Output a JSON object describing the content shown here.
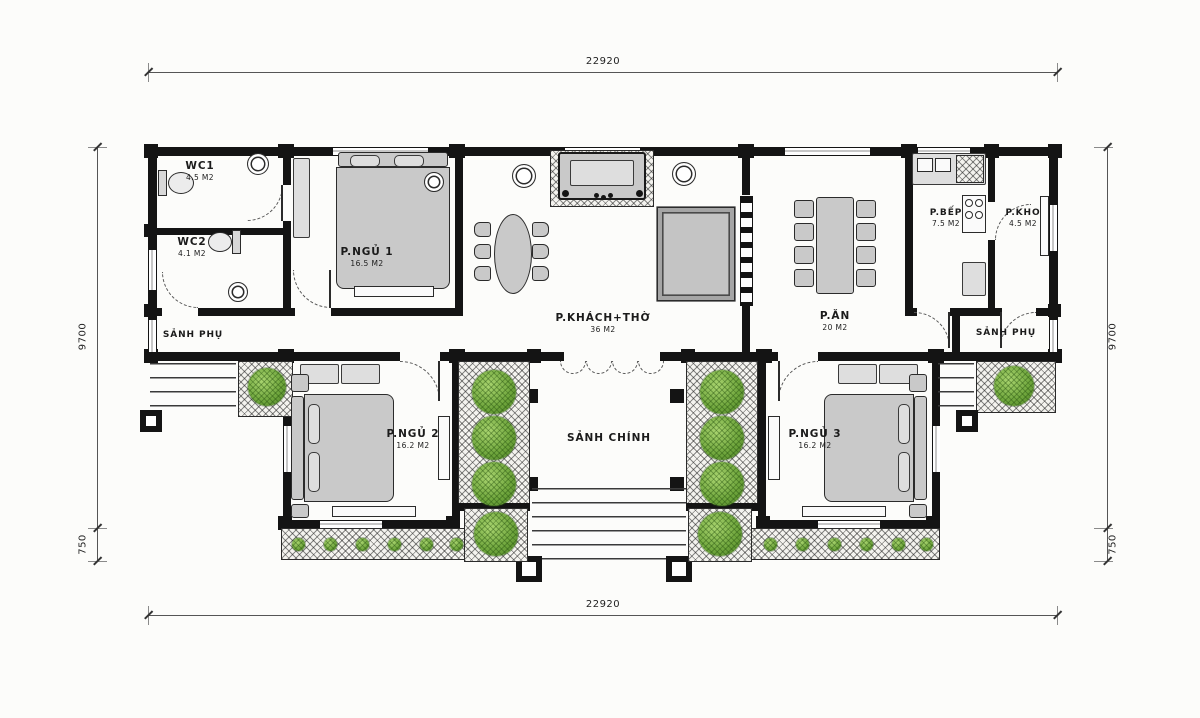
{
  "plan": {
    "rooms": [
      {
        "id": "wc1",
        "name": "WC1",
        "area": "4.5 M2"
      },
      {
        "id": "wc2",
        "name": "WC2",
        "area": "4.1 M2"
      },
      {
        "id": "bedroom1",
        "name": "P.NGỦ 1",
        "area": "16.5 M2"
      },
      {
        "id": "living-worship",
        "name": "P.KHÁCH+THỜ",
        "area": "36 M2"
      },
      {
        "id": "dining",
        "name": "P.ĂN",
        "area": "20 M2"
      },
      {
        "id": "kitchen",
        "name": "P.BẾP",
        "area": "7.5 M2"
      },
      {
        "id": "storage",
        "name": "P.KHO",
        "area": "4.5 M2"
      },
      {
        "id": "side-hall-left",
        "name": "SẢNH PHỤ",
        "area": ""
      },
      {
        "id": "side-hall-right",
        "name": "SẢNH PHỤ",
        "area": ""
      },
      {
        "id": "bedroom2",
        "name": "P.NGỦ 2",
        "area": "16.2 M2"
      },
      {
        "id": "main-hall",
        "name": "SẢNH CHÍNH",
        "area": ""
      },
      {
        "id": "bedroom3",
        "name": "P.NGỦ 3",
        "area": "16.2 M2"
      }
    ],
    "dimensions": {
      "top": "22920",
      "bottom": "22920",
      "left_main": "9700",
      "left_porch": "750",
      "right_main": "9700",
      "right_porch": "750"
    },
    "colors": {
      "wall": "#141414",
      "furniture": "#c9c9c9",
      "plant": "#6fa53c",
      "hatch_line": "#2b2b2b",
      "dim_line": "#555555"
    }
  }
}
